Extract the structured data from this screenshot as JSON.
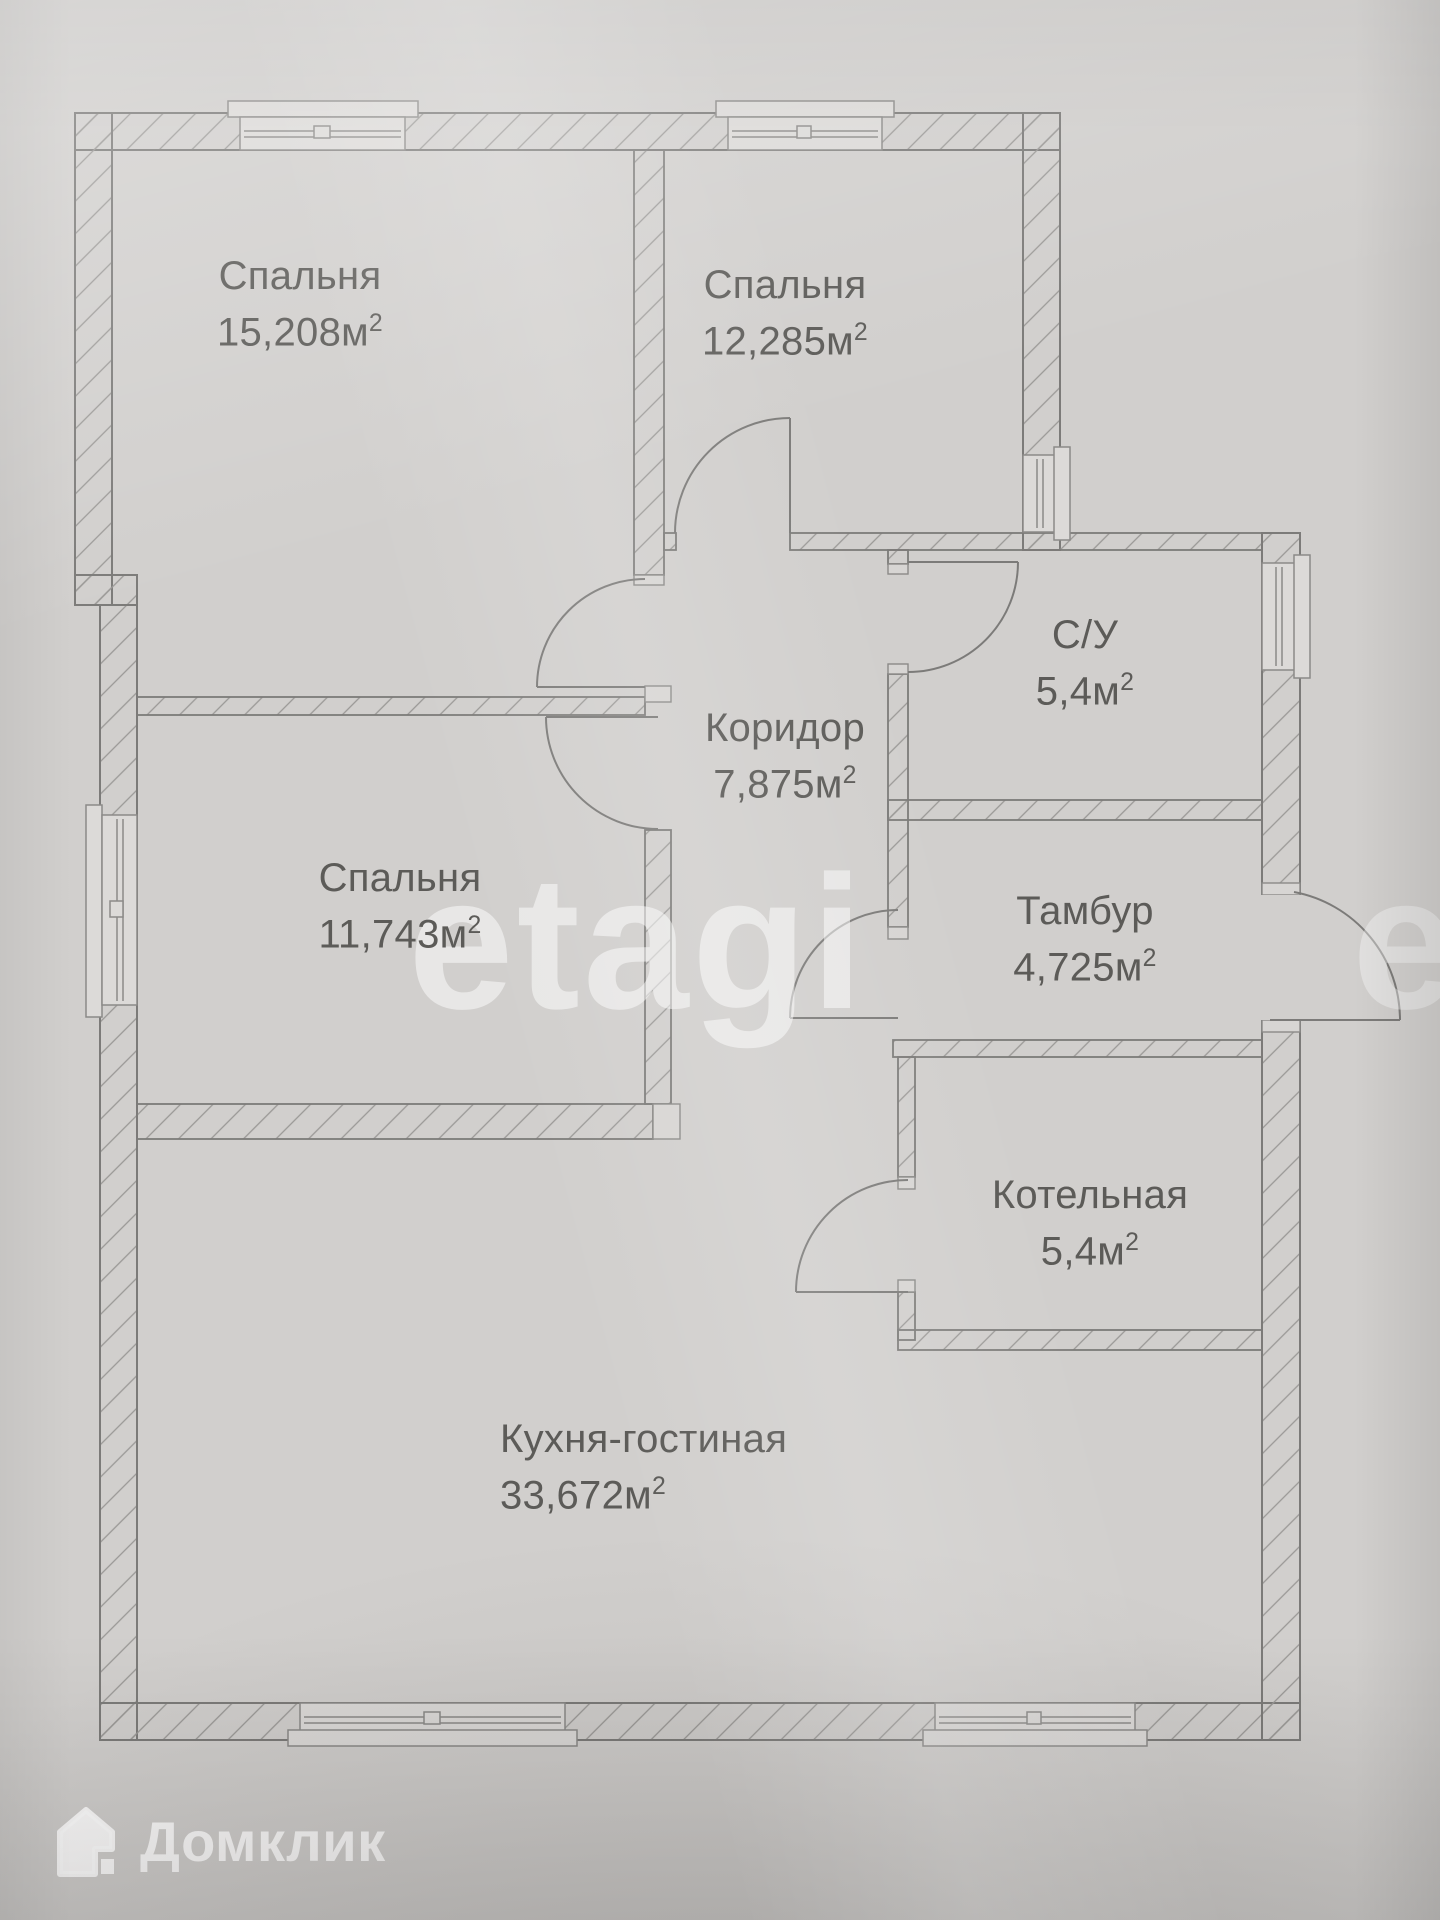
{
  "plan": {
    "rooms": [
      {
        "key": "bedroom-1",
        "name": "Спальня",
        "area": "15,208м",
        "sup": "2"
      },
      {
        "key": "bedroom-2",
        "name": "Спальня",
        "area": "12,285м",
        "sup": "2"
      },
      {
        "key": "bathroom",
        "name": "С/У",
        "area": "5,4м",
        "sup": "2"
      },
      {
        "key": "corridor",
        "name": "Коридор",
        "area": "7,875м",
        "sup": "2"
      },
      {
        "key": "vestibule",
        "name": "Тамбур",
        "area": "4,725м",
        "sup": "2"
      },
      {
        "key": "bedroom-3",
        "name": "Спальня",
        "area": "11,743м",
        "sup": "2"
      },
      {
        "key": "boiler",
        "name": "Котельная",
        "area": "5,4м",
        "sup": "2"
      },
      {
        "key": "kitchen",
        "name": "Кухня-гостиная",
        "area": "33,672м",
        "sup": "2"
      }
    ]
  },
  "watermark": {
    "text": "etagi"
  },
  "brand": {
    "name": "Домклик",
    "icon": "house-icon"
  },
  "colors": {
    "paper": "#d1cfcd",
    "ink": "#7c7b79",
    "hatch": "#9a9896",
    "label_text": "#5c5b58",
    "watermark": "rgba(255,255,255,0.5)",
    "brand_text": "rgba(255,255,255,0.92)"
  }
}
